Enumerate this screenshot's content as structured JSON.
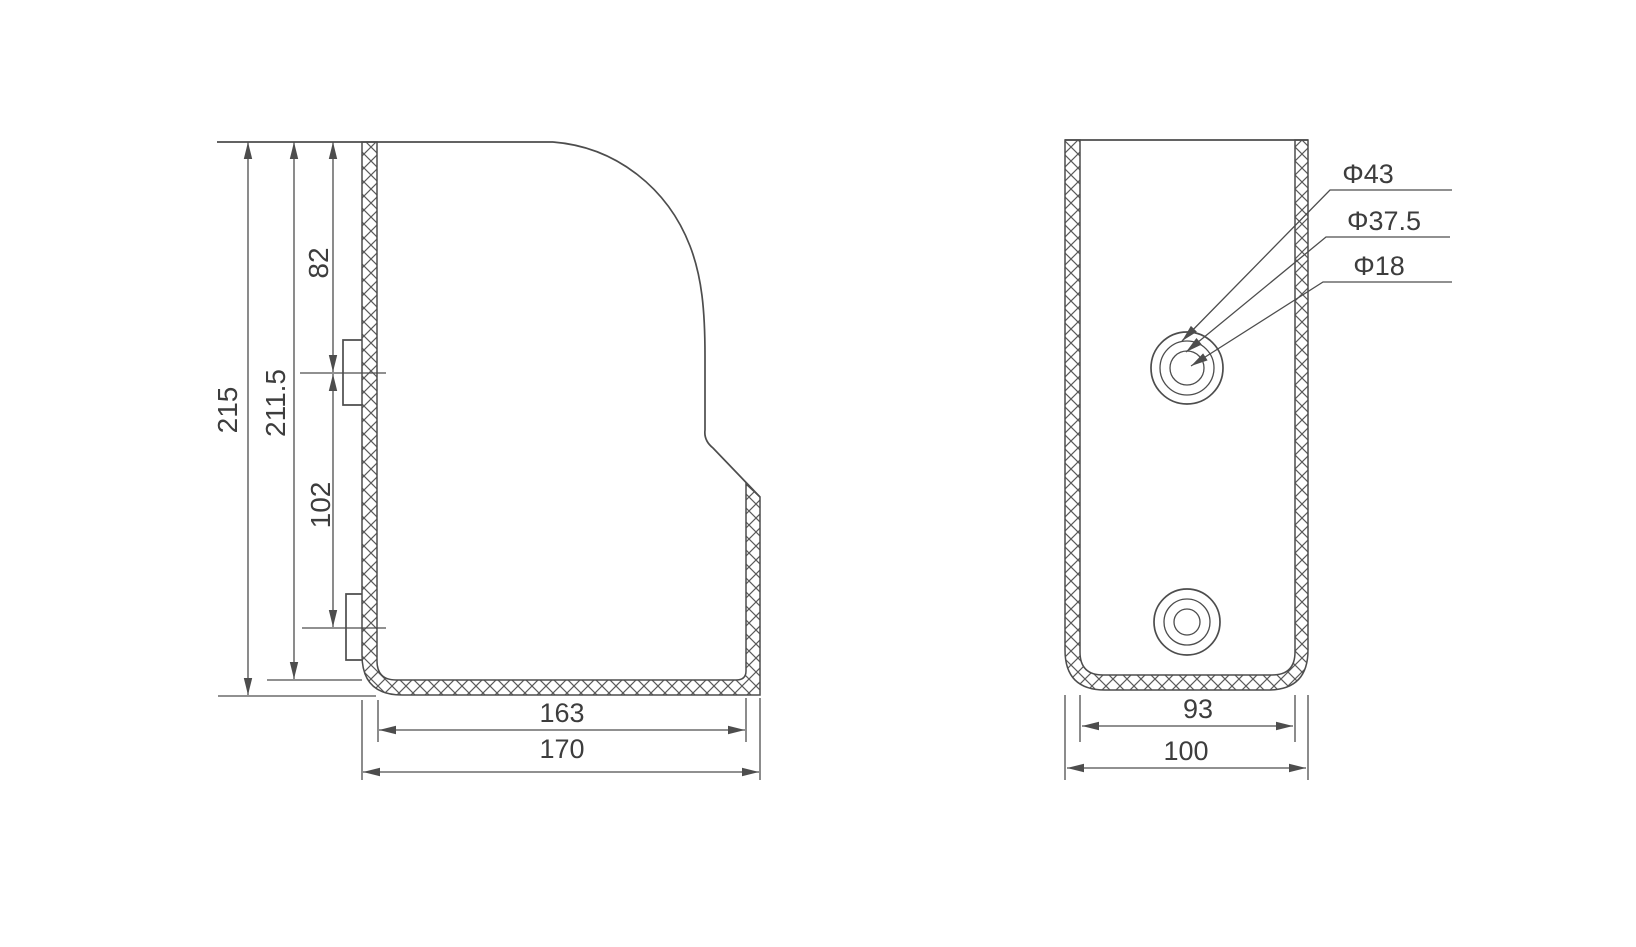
{
  "drawing": {
    "background": "#ffffff",
    "line_color": "#4d4d4d",
    "hatch_color": "#5a5a5a",
    "text_color": "#3d3d3d",
    "side_view": {
      "dim_215": "215",
      "dim_211_5": "211.5",
      "dim_82": "82",
      "dim_102": "102",
      "dim_163": "163",
      "dim_170": "170"
    },
    "front_view": {
      "dim_93": "93",
      "dim_100": "100",
      "callout_43": "Φ43",
      "callout_37_5": "Φ37.5",
      "callout_18": "Φ18"
    }
  }
}
